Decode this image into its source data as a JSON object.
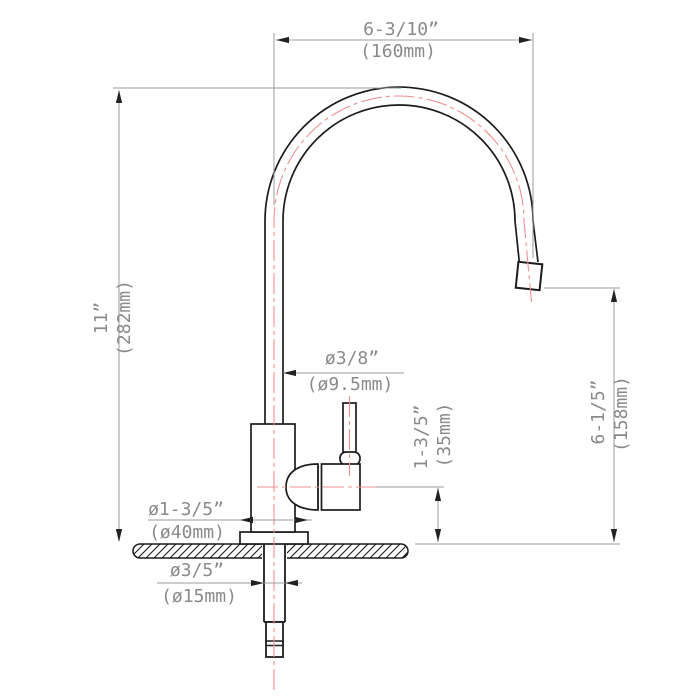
{
  "drawing": {
    "kind": "faucet-dimensional-drawing",
    "dims": {
      "spout_width": {
        "inch": "6-3/10”",
        "mm": "(160mm)"
      },
      "total_height": {
        "inch": "11”",
        "mm": "(282mm)"
      },
      "spout_tube_diameter": {
        "inch": "ø3/8”",
        "mm": "(ø9.5mm)"
      },
      "handle_center_height": {
        "inch": "1-3/5”",
        "mm": "(35mm)"
      },
      "outlet_height": {
        "inch": "6-1/5”",
        "mm": "(158mm)"
      },
      "base_diameter": {
        "inch": "ø1-3/5”",
        "mm": "(ø40mm)"
      },
      "shank_diameter": {
        "inch": "ø3/5”",
        "mm": "(ø15mm)"
      }
    },
    "colors": {
      "outline": "#1c1c1c",
      "dimension_lines": "#9b9b9b",
      "label_text": "#8a8a8a",
      "centerline": "#f09090",
      "background": "#ffffff"
    }
  }
}
